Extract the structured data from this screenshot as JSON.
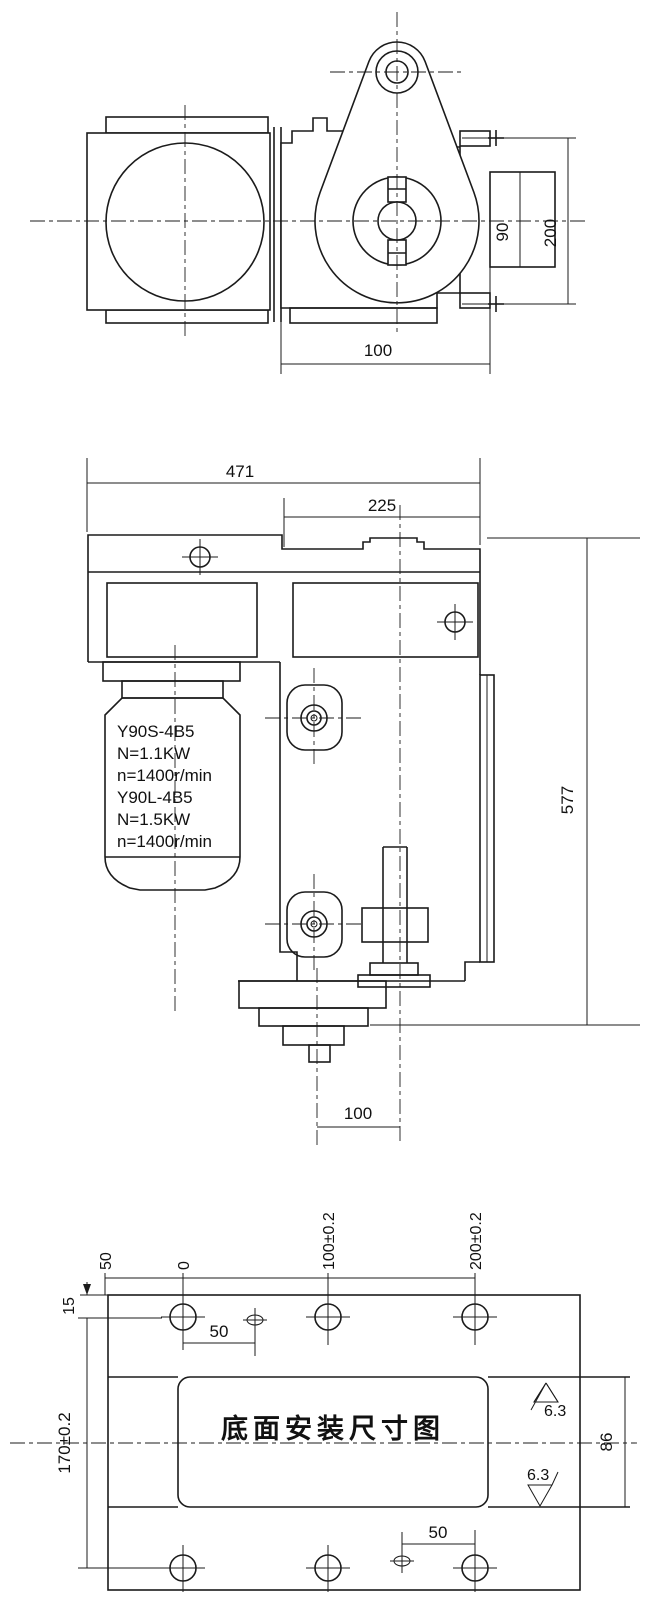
{
  "drawing": {
    "top_view": {
      "dim_100": "100",
      "dim_90": "90",
      "dim_200": "200"
    },
    "front_view": {
      "dim_471": "471",
      "dim_225": "225",
      "dim_577": "577",
      "dim_100": "100",
      "motor_label": [
        "Y90S-4B5",
        "N=1.1KW",
        "n=1400r/min",
        "Y90L-4B5",
        "N=1.5KW",
        "n=1400r/min"
      ]
    },
    "bottom_view": {
      "title": "底面安装尺寸图",
      "ordinate": [
        "50",
        "0",
        "100±0.2",
        "200±0.2"
      ],
      "dim_15": "15",
      "dim_170": "170±0.2",
      "dim_50_upper": "50",
      "dim_50_lower": "50",
      "dim_86": "86",
      "roughness_upper": "6.3",
      "roughness_lower": "6.3"
    },
    "colors": {
      "line": "#1b1b1b",
      "background": "#ffffff"
    }
  }
}
